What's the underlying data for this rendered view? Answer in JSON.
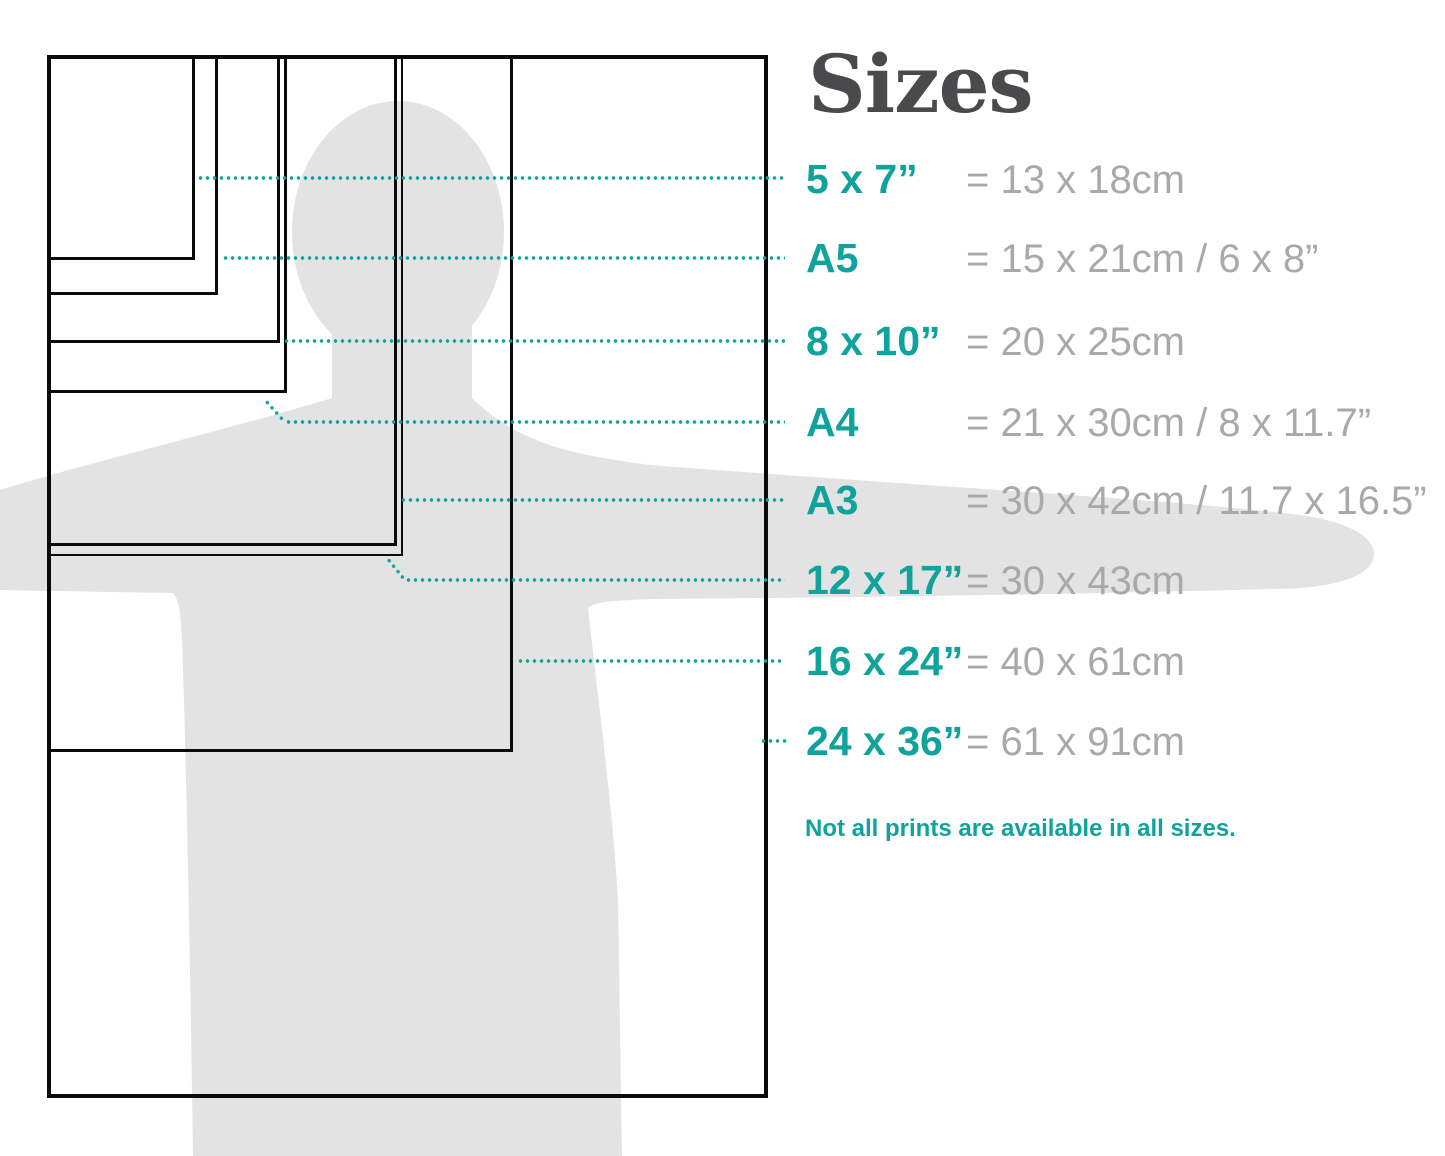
{
  "title": "Sizes",
  "note": "Not all prints are available in all sizes.",
  "colors": {
    "accent_teal": "#10a39b",
    "metric_gray": "#a7a9ab",
    "title_gray": "#4a4a4c",
    "silhouette_gray": "#e3e3e3",
    "outline_black": "#0a0a0a"
  },
  "sizes": [
    {
      "label": "5 x 7”",
      "metric": "= 13 x 18cm"
    },
    {
      "label": "A5",
      "metric": "= 15 x 21cm / 6 x 8”"
    },
    {
      "label": "8 x 10”",
      "metric": "= 20 x 25cm"
    },
    {
      "label": "A4",
      "metric": "= 21 x 30cm / 8 x 11.7”"
    },
    {
      "label": "A3",
      "metric": "= 30 x 42cm / 11.7 x 16.5”"
    },
    {
      "label": "12 x 17”",
      "metric": "= 30 x 43cm"
    },
    {
      "label": "16 x 24”",
      "metric": "= 40 x 61cm"
    },
    {
      "label": "24 x 36”",
      "metric": "= 61 x 91cm"
    }
  ]
}
